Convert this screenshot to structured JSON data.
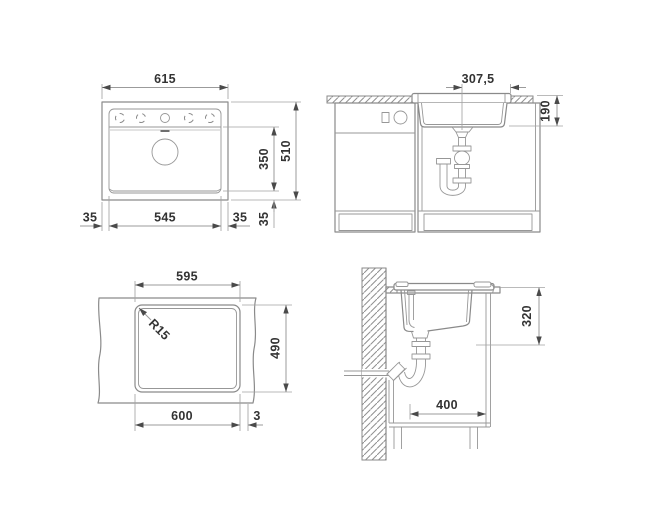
{
  "title": "Sink installation technical drawing",
  "colors": {
    "line": "#8a8a8a",
    "text": "#333333",
    "arrow": "#4a4a4a",
    "background": "#ffffff"
  },
  "views": {
    "top_view": {
      "label": "sink top view",
      "dims": {
        "overall_width": "615",
        "overall_depth": "510",
        "bowl_inner_depth": "350",
        "edge_bottom_side": "35",
        "edge_left": "35",
        "bowl_inner_width": "545",
        "edge_right": "35"
      }
    },
    "front_section": {
      "label": "front view in cabinet",
      "dims": {
        "drain_center_offset": "307,5",
        "bowl_depth": "190"
      }
    },
    "cutout_plan": {
      "label": "worktop cutout plan",
      "dims": {
        "cutout_width_top": "595",
        "corner_radius": "R15",
        "cutout_depth": "490",
        "cutout_width_bottom": "600",
        "edge_offset": "3"
      }
    },
    "side_section": {
      "label": "side section at wall",
      "dims": {
        "clearance_height": "320",
        "min_clear_depth": "400"
      }
    }
  }
}
